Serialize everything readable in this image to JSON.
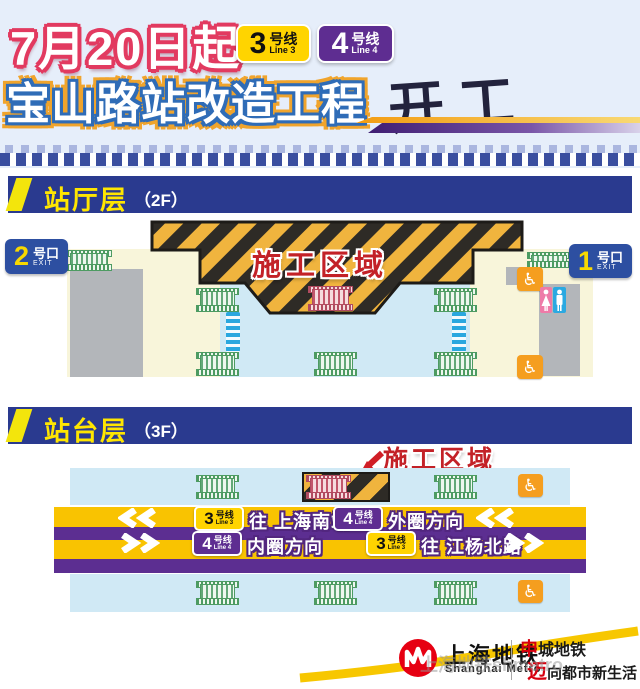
{
  "header": {
    "date_title": "7月20日起",
    "main_title": "宝山路站改造工程",
    "start_word": "开工"
  },
  "lines": {
    "line3": {
      "num": "3",
      "name": "号线",
      "sub": "Line 3"
    },
    "line4": {
      "num": "4",
      "name": "号线",
      "sub": "Line 4"
    }
  },
  "sections": {
    "hall": {
      "title": "站厅层",
      "floor": "（2F）"
    },
    "platform": {
      "title": "站台层",
      "floor": "（3F）"
    }
  },
  "hall": {
    "construction_label": "施工区域",
    "exit2": {
      "num": "2",
      "name": "号口",
      "exit": "EXIT"
    },
    "exit1": {
      "num": "1",
      "name": "号口",
      "exit": "EXIT"
    }
  },
  "platform": {
    "construction_label": "施工区域",
    "track_up": {
      "dest1": "往 上海南站",
      "dest2": "外圈方向"
    },
    "track_down": {
      "dest1": "内圈方向",
      "dest2": "往 江杨北路"
    }
  },
  "footer": {
    "logo_cn": "上海地铁",
    "logo_en": "Shanghai Metro",
    "brand1_red": "申",
    "brand1_black": "城地铁",
    "brand2_red": "迈",
    "brand2_black": "向都市新生活",
    "watermark": "上海地铁shmetro"
  },
  "icons": {
    "wheelchair": "♿"
  },
  "colors": {
    "header_bg": "#e6eefa",
    "title_outline_red": "#e23a60",
    "title_outline_blue": "#2f6cb7",
    "title_outline_orange": "#f0a42c",
    "section_bar_navy": "#2a3a8f",
    "section_text_yellow": "#ffe600",
    "line3_yellow": "#ffd400",
    "line4_purple": "#5e2d91",
    "hazard_orange": "#f0b43e",
    "hazard_dark": "#2e2b26",
    "construction_red": "#c32127",
    "cream_area": "#f8f5da",
    "paid_area_blue": "#d0e9f5",
    "gray_block": "#b3b6ba",
    "escalator_green": "#4d9b62",
    "gate_blue": "#2aa7df",
    "band_yellow": "#f9c301",
    "band_purple": "#5c2e91",
    "exit_badge_blue": "#2d4fa1",
    "wheelchair_orange": "#f59e1f",
    "toilet_pink": "#ee7bа8",
    "toilet_blue": "#2ba9e1",
    "metro_logo_red": "#e60012",
    "footer_swoosh_yellow": "#f7c700"
  }
}
